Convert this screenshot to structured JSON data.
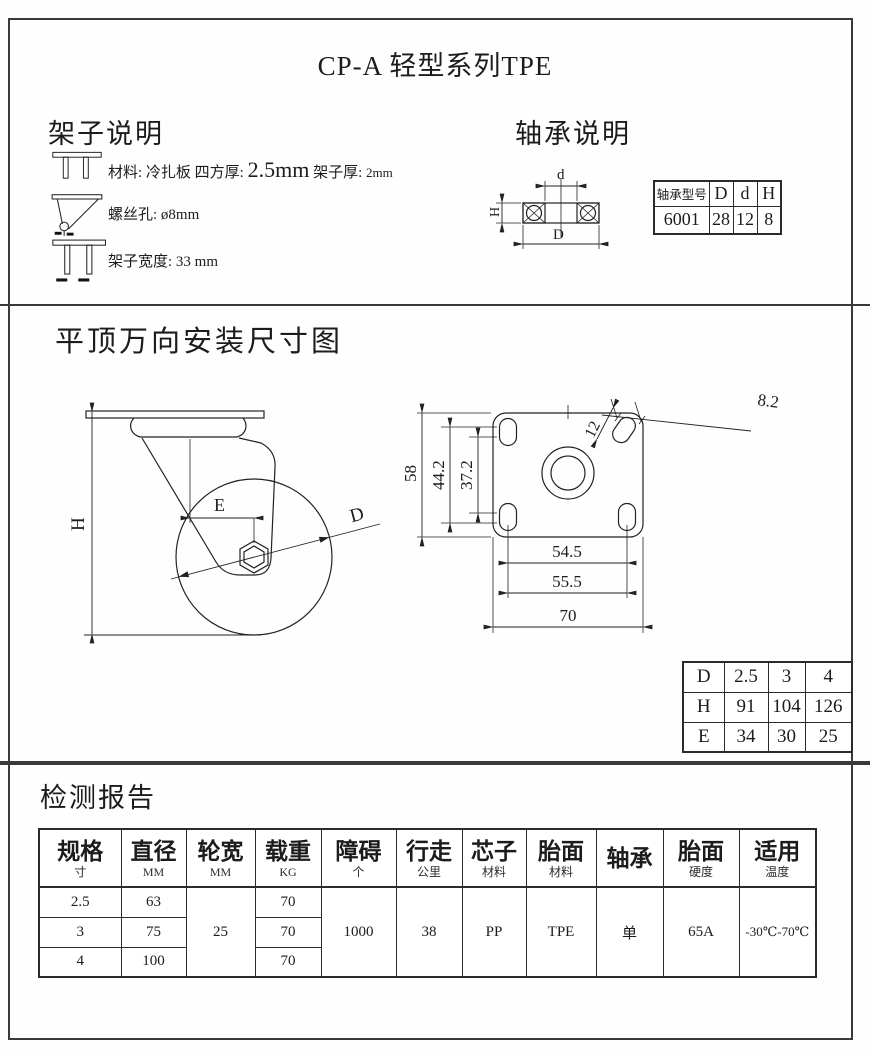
{
  "page": {
    "title": "CP-A  轻型系列TPE"
  },
  "frame_section": {
    "heading": "架子说明",
    "row1": {
      "a": "材料: 冷扎板   四方厚: ",
      "b": "2.5mm",
      "c": "  架子厚: ",
      "d": "2mm"
    },
    "row2": {
      "a": "螺丝孔: ",
      "b": "ø8mm"
    },
    "row3": {
      "a": "架子宽度: ",
      "b": "33 mm"
    }
  },
  "bearing_section": {
    "heading": "轴承说明",
    "diagram_labels": {
      "d": "d",
      "D": "D",
      "H": "H"
    },
    "table": {
      "headers": [
        "轴承型号",
        "D",
        "d",
        "H"
      ],
      "row": [
        "6001",
        "28",
        "12",
        "8"
      ]
    }
  },
  "install_section": {
    "heading": "平顶万向安装尺寸图",
    "side_view_labels": {
      "H": "H",
      "E": "E",
      "D": "D"
    },
    "plate_labels": {
      "v58": "58",
      "v44_2": "44.2",
      "v37_2": "37.2",
      "v12": "12",
      "v8_2": "8.2",
      "v54_5": "54.5",
      "v55_5": "55.5",
      "v70": "70"
    },
    "dhe_table": {
      "rows": [
        [
          "D",
          "2.5",
          "3",
          "4"
        ],
        [
          "H",
          "91",
          "104",
          "126"
        ],
        [
          "E",
          "34",
          "30",
          "25"
        ]
      ]
    }
  },
  "report_section": {
    "heading": "检测报告",
    "columns": [
      {
        "main": "规格",
        "sub": "寸"
      },
      {
        "main": "直径",
        "sub": "MM"
      },
      {
        "main": "轮宽",
        "sub": "MM"
      },
      {
        "main": "载重",
        "sub": "KG"
      },
      {
        "main": "障碍",
        "sub": "个"
      },
      {
        "main": "行走",
        "sub": "公里"
      },
      {
        "main": "芯子",
        "sub": "材料"
      },
      {
        "main": "胎面",
        "sub": "材料"
      },
      {
        "main": "轴承",
        "sub": ""
      },
      {
        "main": "胎面",
        "sub": "硬度"
      },
      {
        "main": "适用",
        "sub": "温度"
      }
    ],
    "spec": [
      "2.5",
      "3",
      "4"
    ],
    "diameter": [
      "63",
      "75",
      "100"
    ],
    "wheel_width": "25",
    "load": [
      "70",
      "70",
      "70"
    ],
    "obstacle": "1000",
    "travel": "38",
    "core_material": "PP",
    "tread_material": "TPE",
    "bearing": "单",
    "tread_hardness": "65A",
    "temperature": "-30℃-70℃"
  }
}
